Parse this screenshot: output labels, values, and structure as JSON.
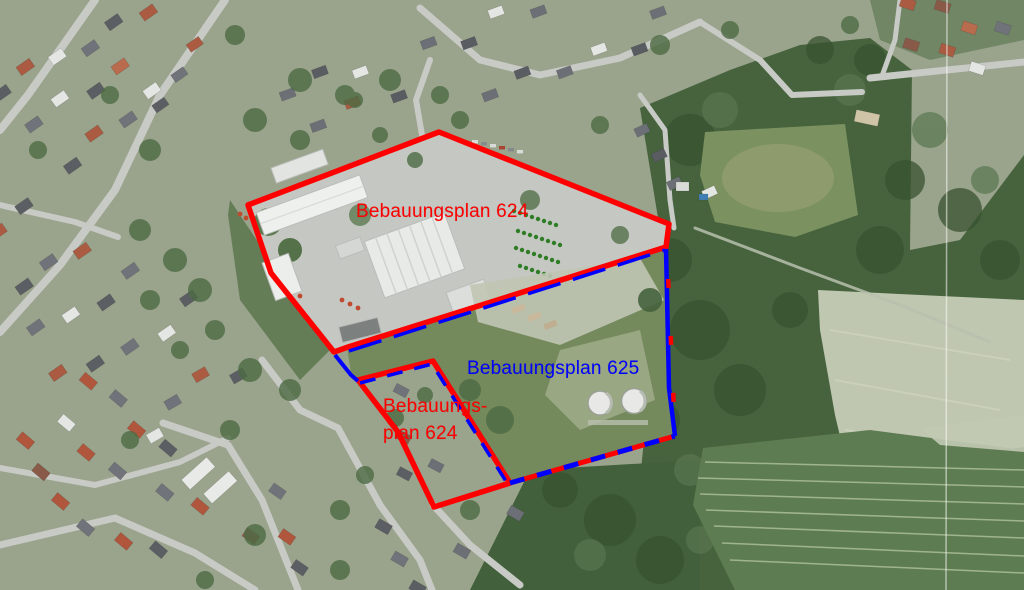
{
  "map": {
    "type": "aerial-imagery-with-development-plan-overlay",
    "labels": {
      "plan624_main": "Bebauungsplan 624",
      "plan625": "Bebauungsplan 625",
      "plan624_small_line1": "Bebauungs-",
      "plan624_small_line2": "plan 624"
    },
    "colors": {
      "plan624_boundary": "#ff0000",
      "plan625_boundary": "#0000ff"
    }
  }
}
